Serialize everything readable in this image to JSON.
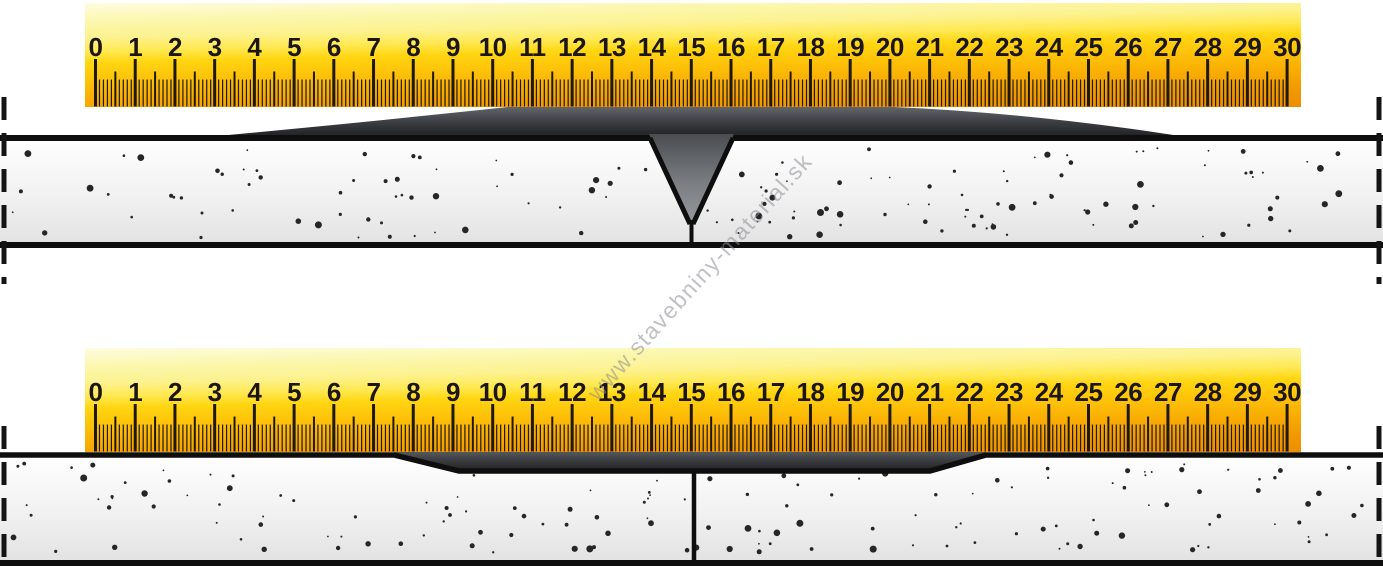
{
  "watermark": "www.stavebniny-material.sk",
  "ruler": {
    "numbers": [
      "0",
      "1",
      "2",
      "3",
      "4",
      "5",
      "6",
      "7",
      "8",
      "9",
      "10",
      "11",
      "12",
      "13",
      "14",
      "15",
      "16",
      "17",
      "18",
      "19",
      "20",
      "21",
      "22",
      "23",
      "24",
      "25",
      "26",
      "27",
      "28",
      "29",
      "30"
    ],
    "tick_color": "#1d1812",
    "number_color": "#1b1611",
    "face_top_color": "#fbf7ad",
    "face_bottom_color": "#ee8e00"
  },
  "diagrams": [
    {
      "id": "slab-with-v-groove-joint-filled",
      "joint_ruler_position": "15"
    },
    {
      "id": "slab-with-levelled-joint-compound",
      "joint_ruler_position": "15"
    }
  ],
  "colors": {
    "concrete_light": "#ffffff",
    "concrete_shade": "#e2e2e2",
    "speckle": "#262626",
    "outline": "#0e0e0e",
    "compound_light": "#63676c",
    "compound_dark": "#1d1d1f",
    "groove_fill_top": "#4a4c50",
    "groove_fill_bottom": "#97999e"
  },
  "speckles": {
    "count_per_slab": 150,
    "seed": 7
  }
}
